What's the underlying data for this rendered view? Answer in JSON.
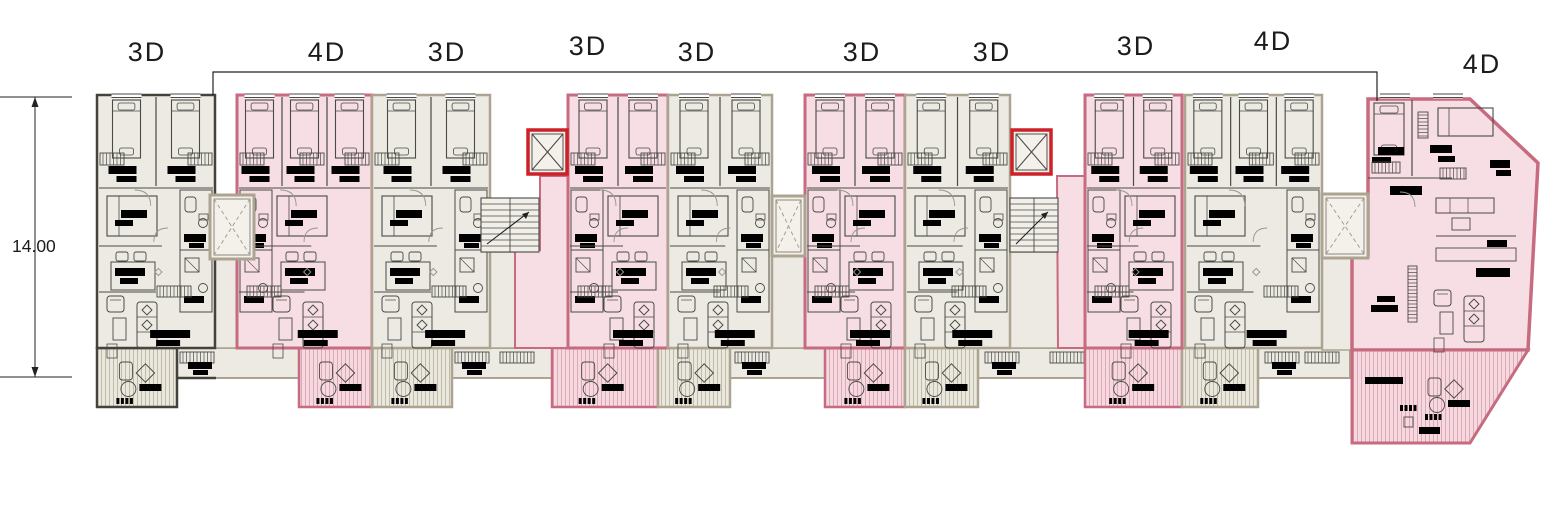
{
  "plan": {
    "name": "residential-floor-plan",
    "width": 1553,
    "height": 530
  },
  "dimension": {
    "value": "14.00",
    "text_x": 12,
    "text_y": 252,
    "line_x": 35,
    "y1": 97,
    "y2": 377,
    "tick_x1": 0,
    "tick_x2": 72
  },
  "boundary": {
    "y": 72,
    "x1": 213,
    "x2": 1377,
    "drop1_y": 95,
    "drop2_y": 101
  },
  "colors": {
    "background": "#ffffff",
    "beige_fill": "#eceae2",
    "beige_border": "#aca491",
    "dark_border": "#45423c",
    "pink_fill": "#f6dee4",
    "pink_border": "#c76b80",
    "red_elevator": "#cb2128",
    "ink": "#4a4a46",
    "light": "#979790",
    "black": "#000000",
    "hatch_beige": "#bcb5a4",
    "hatch_pink": "#dba4b2",
    "balcony_beige": "#eae7dd",
    "balcony_pink": "#f5d8e0",
    "text": "#1c1c1c"
  },
  "units": [
    {
      "label": "3D",
      "label_x": 147,
      "label_y": 51,
      "x": 97,
      "w": 118,
      "beds": 2,
      "style": "dark"
    },
    {
      "label": "4D",
      "label_x": 327,
      "label_y": 51,
      "x": 237,
      "w": 135,
      "beds": 3,
      "style": "pink"
    },
    {
      "label": "3D",
      "label_x": 447,
      "label_y": 51,
      "x": 372,
      "w": 118,
      "beds": 2,
      "style": "beige"
    },
    {
      "label": "3D",
      "label_x": 588,
      "label_y": 45,
      "x": 568,
      "w": 100,
      "beds": 2,
      "style": "pink"
    },
    {
      "label": "3D",
      "label_x": 697,
      "label_y": 51,
      "x": 668,
      "w": 104,
      "beds": 2,
      "style": "beige"
    },
    {
      "label": "3D",
      "label_x": 862,
      "label_y": 51,
      "x": 805,
      "w": 100,
      "beds": 2,
      "style": "pink"
    },
    {
      "label": "3D",
      "label_x": 992,
      "label_y": 51,
      "x": 905,
      "w": 105,
      "beds": 2,
      "style": "beige"
    },
    {
      "label": "3D",
      "label_x": 1136,
      "label_y": 45,
      "x": 1085,
      "w": 97,
      "beds": 2,
      "style": "pink"
    },
    {
      "label": "4D",
      "label_x": 1273,
      "label_y": 40,
      "x": 1185,
      "w": 137,
      "beds": 3,
      "style": "beige"
    },
    {
      "label": "4D",
      "label_x": 1482,
      "label_y": 63,
      "style": "pink",
      "custom": true,
      "outline": [
        [
          1368,
          99
        ],
        [
          1470,
          99
        ],
        [
          1538,
          163
        ],
        [
          1528,
          350
        ],
        [
          1352,
          350
        ],
        [
          1352,
          255
        ],
        [
          1368,
          255
        ]
      ],
      "balcony_outline": [
        [
          1352,
          350
        ],
        [
          1528,
          350
        ],
        [
          1470,
          443
        ],
        [
          1352,
          443
        ]
      ]
    }
  ],
  "band": {
    "x1": 97,
    "x2": 1350,
    "y1": 348,
    "y2": 378,
    "dark_until": 216,
    "combs": [
      180,
      455,
      500,
      735,
      985,
      1050,
      1265,
      1305
    ],
    "bars": [
      188,
      462,
      742,
      992,
      1272
    ]
  },
  "balconies": [
    {
      "x": 97,
      "w": 80,
      "style": "dark"
    },
    {
      "x": 299,
      "w": 73,
      "style": "pink"
    },
    {
      "x": 372,
      "w": 80,
      "style": "beige"
    },
    {
      "x": 552,
      "w": 106,
      "style": "pink"
    },
    {
      "x": 658,
      "w": 72,
      "style": "beige"
    },
    {
      "x": 825,
      "w": 80,
      "style": "pink"
    },
    {
      "x": 905,
      "w": 73,
      "style": "beige"
    },
    {
      "x": 1085,
      "w": 97,
      "style": "pink"
    },
    {
      "x": 1182,
      "w": 76,
      "style": "beige"
    }
  ],
  "balcony_y2": 407,
  "cores": {
    "elevators": [
      {
        "x": 210,
        "y": 195,
        "w": 44,
        "h": 64,
        "red": false
      },
      {
        "x": 772,
        "y": 196,
        "w": 33,
        "h": 60,
        "red": false
      },
      {
        "x": 1322,
        "y": 194,
        "w": 46,
        "h": 64,
        "red": false
      },
      {
        "x": 528,
        "y": 130,
        "w": 39,
        "h": 44,
        "red": true
      },
      {
        "x": 1012,
        "y": 130,
        "w": 39,
        "h": 44,
        "red": true
      }
    ],
    "stairs": [
      {
        "x": 481,
        "y": 198,
        "w": 58,
        "h": 54
      },
      {
        "x": 1010,
        "y": 198,
        "w": 48,
        "h": 54
      }
    ],
    "corridors": [
      {
        "x": 490,
        "y": 252,
        "w": 78,
        "h": 96
      },
      {
        "x": 1010,
        "y": 252,
        "w": 75,
        "h": 96
      },
      {
        "x": 210,
        "y": 259,
        "w": 44,
        "h": 89
      },
      {
        "x": 772,
        "y": 256,
        "w": 33,
        "h": 92
      },
      {
        "x": 1322,
        "y": 258,
        "w": 46,
        "h": 92
      }
    ],
    "pink_corridors": [
      [
        [
          540,
          176
        ],
        [
          568,
          176
        ],
        [
          568,
          348
        ],
        [
          515,
          348
        ],
        [
          515,
          250
        ],
        [
          540,
          250
        ]
      ],
      [
        [
          1057,
          176
        ],
        [
          1085,
          176
        ],
        [
          1085,
          348
        ],
        [
          1058,
          348
        ]
      ]
    ]
  }
}
